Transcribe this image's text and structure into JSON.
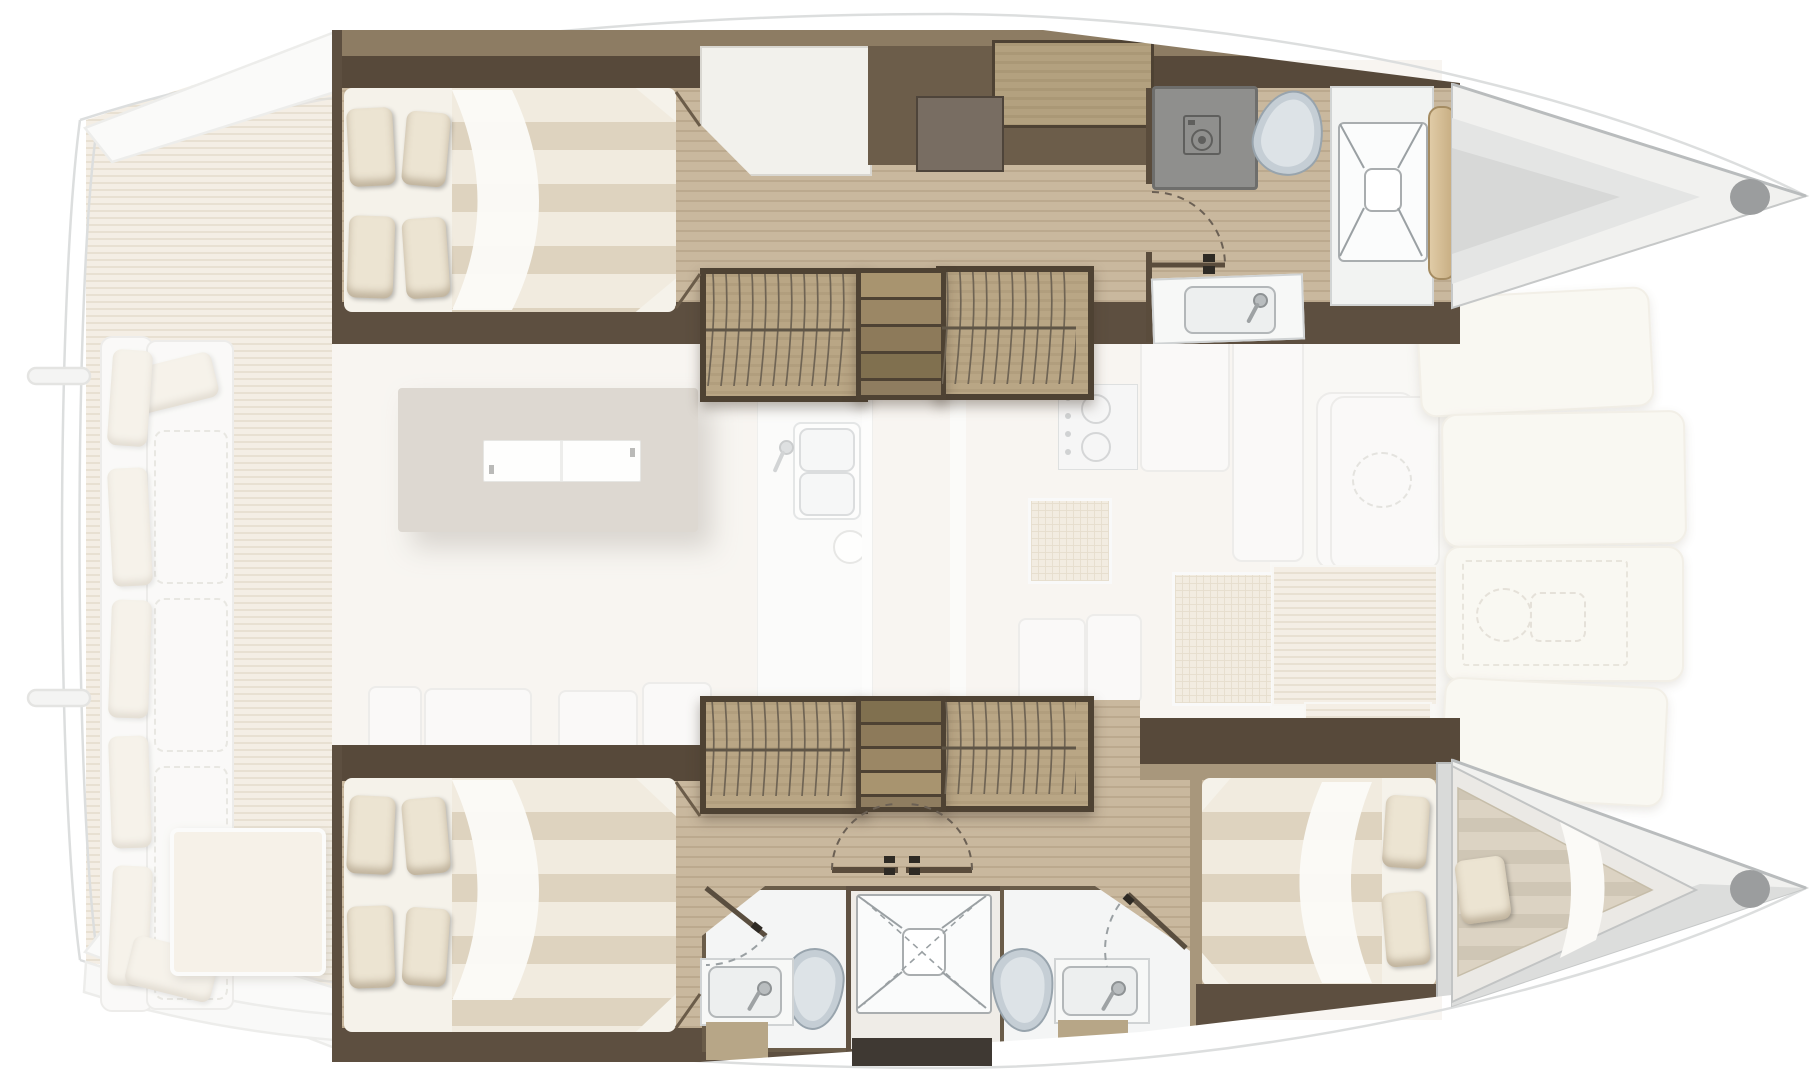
{
  "floor_plan": {
    "title": "Catamaran interior layout — top-down floor plan, bow to the right",
    "vessel_type": "sailing catamaran",
    "view": "deck and hull accommodation plan",
    "bow_direction": "right",
    "legend": "Saturated areas are hull interiors; faded areas are the main deck level"
  },
  "rooms": {
    "port_aft_cabin": {
      "label": "Port aft double cabin",
      "furniture": [
        "double bed",
        "4 pillows",
        "striped duvet"
      ]
    },
    "port_seat": {
      "label": "Port hull seat"
    },
    "port_desk": {
      "label": "Chart desk"
    },
    "port_cabinet": {
      "label": "Wood cabinet"
    },
    "port_wardrobe_aft": {
      "label": "Hanging wardrobe"
    },
    "port_wardrobe_fwd": {
      "label": "Hanging wardrobe"
    },
    "port_steps": {
      "label": "Companionway steps"
    },
    "port_bathroom": {
      "label": "Port forward bathroom",
      "furniture": [
        "washing machine",
        "toilet",
        "washbasin"
      ]
    },
    "port_shower": {
      "label": "Port separate shower"
    },
    "port_bow": {
      "label": "Port bow compartment"
    },
    "stbd_aft_cabin": {
      "label": "Starboard aft double cabin",
      "furniture": [
        "double bed",
        "4 pillows",
        "striped duvet"
      ]
    },
    "stbd_wardrobe_aft": {
      "label": "Hanging wardrobe"
    },
    "stbd_wardrobe_fwd": {
      "label": "Hanging wardrobe"
    },
    "stbd_steps": {
      "label": "Companionway steps"
    },
    "stbd_corridor_doors": {
      "label": "Double swing doors"
    },
    "stbd_bathroom_aft": {
      "label": "Aft bathroom",
      "furniture": [
        "toilet",
        "washbasin",
        "shower door"
      ]
    },
    "stbd_shower_central": {
      "label": "Central shower cabin"
    },
    "stbd_bathroom_fwd": {
      "label": "Forward bathroom",
      "furniture": [
        "toilet",
        "washbasin",
        "shower door"
      ]
    },
    "stbd_fwd_cabin": {
      "label": "Starboard forward double cabin",
      "furniture": [
        "double bed",
        "2 pillows"
      ]
    },
    "stbd_forepeak": {
      "label": "Forepeak berth",
      "furniture": [
        "single berth",
        "pillow"
      ]
    },
    "aft_cockpit": {
      "label": "Aft cockpit",
      "furniture": [
        "transom sofa with pillows",
        "cockpit table",
        "teak deck",
        "swim platform"
      ]
    },
    "saloon": {
      "label": "Saloon",
      "furniture": [
        "dining table",
        "white sideboard top",
        "bench seats"
      ]
    },
    "galley": {
      "label": "Galley",
      "furniture": [
        "double sink",
        "stove",
        "refrigerator cabinets"
      ]
    },
    "foredeck": {
      "label": "Foredeck",
      "furniture": [
        "sun lounging cushions",
        "deck hatch",
        "teak steps"
      ]
    },
    "windlass": {
      "label": "Windlass locker (dashed outline)"
    },
    "fwd_cockpit": {
      "label": "Forward cockpit bench"
    }
  },
  "colors": {
    "hull_floor_wood": "#c9b89e",
    "dark_wall_wood": "#57493a",
    "wardrobe_wood": "#b9a685",
    "mattress_cream": "#f1ebdf",
    "mattress_stripe": "#ded3bf",
    "pillow": "#ece4d2",
    "teak_deck": "#e8dcc7",
    "saloon_floor": "#f0ebe2",
    "table_top": "#b7ac9c",
    "toilet_ceramic": "#c5ced5",
    "washer_gray": "#8f8f8d",
    "bow_shell": "#f1f1ef",
    "sun_cushion": "#f4f0e4"
  }
}
